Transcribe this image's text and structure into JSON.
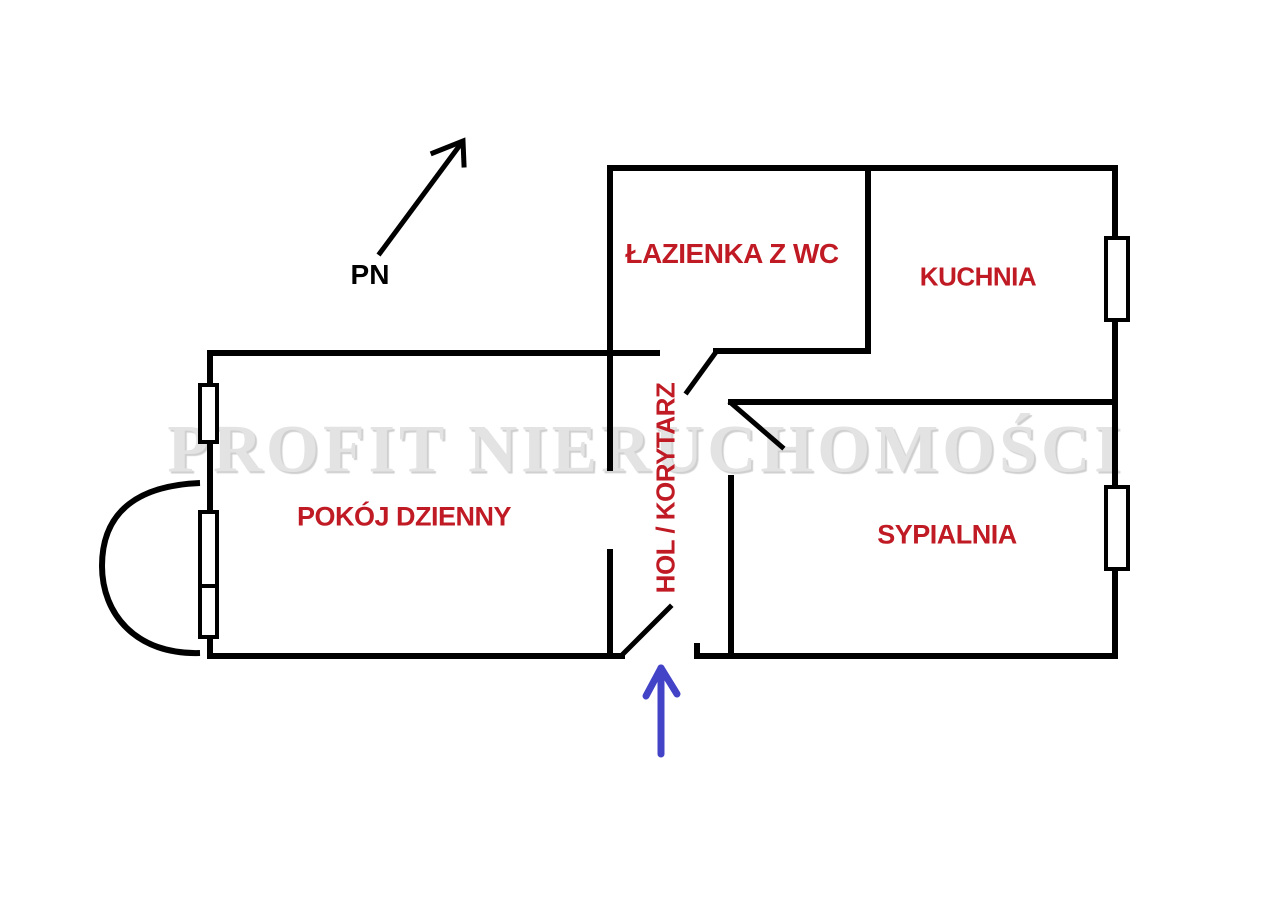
{
  "watermark": {
    "text": "PROFIT NIERUCHOMOŚCI",
    "color": "#e3e3e3"
  },
  "north_indicator": {
    "label": "PN",
    "icon": "arrow-up-right-icon"
  },
  "entrance_arrow": {
    "icon": "arrow-up-icon",
    "color": "#4343c8"
  },
  "rooms": [
    {
      "id": "lazienka",
      "label": "ŁAZIENKA Z WC"
    },
    {
      "id": "kuchnia",
      "label": "KUCHNIA"
    },
    {
      "id": "pokoj-dzienny",
      "label": "POKÓJ DZIENNY"
    },
    {
      "id": "hol-korytarz",
      "label": "HOL / KORYTARZ",
      "orientation": "vertical-bottom-to-top"
    },
    {
      "id": "sypialnia",
      "label": "SYPIALNIA"
    }
  ],
  "colors": {
    "background": "#ffffff",
    "wall": "#000000",
    "room_label": "#c01b24",
    "north_label": "#000000",
    "entrance_arrow": "#4343c8",
    "watermark": "#e3e3e3"
  }
}
